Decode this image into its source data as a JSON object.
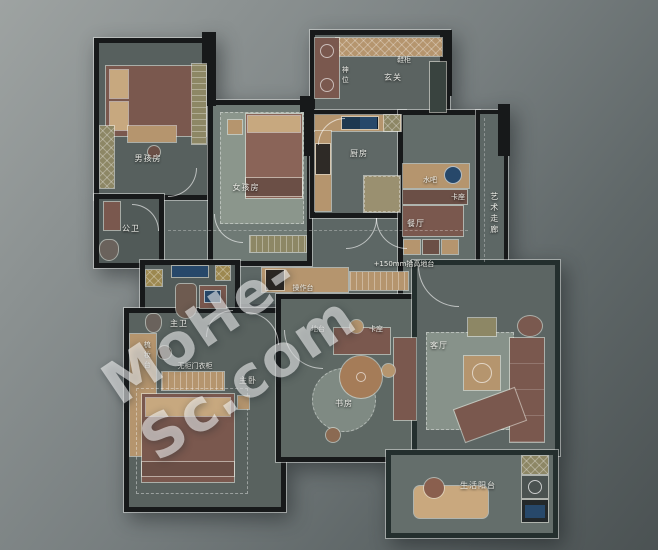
{
  "watermark": {
    "text": "MoHe-Sc.com"
  },
  "labels": {
    "boy_room": "男孩房",
    "girl_room": "女孩房",
    "entry": "玄关",
    "shoe_cabinet": "鞋柜",
    "altar": "神位",
    "kitchen": "厨房",
    "water_bar": "水吧",
    "dining_booth": "卡座",
    "dining": "餐厅",
    "art_corridor": "艺术走廊",
    "guest_bath": "公卫",
    "master_bath": "主卫",
    "dressing_table": "梳妆台",
    "open_wardrobe": "无柜门衣柜",
    "master_bedroom": "主卧",
    "study": "书房",
    "platform": "地台",
    "study_booth": "卡座",
    "counter": "操作台",
    "platform_note": "+150mm抬高地台",
    "living_room": "客厅",
    "service_balcony": "生活阳台"
  },
  "colors": {
    "wall": "#17191a",
    "floor": "#5e6866",
    "wood": "#b5956e",
    "furniture_brown": "#7a584e",
    "appliance_blue": "#27486a",
    "cabinet_olive": "#8d8765",
    "rug": "#87928a",
    "background_light": "#9ea3a2",
    "background_dark": "#4b5253"
  }
}
